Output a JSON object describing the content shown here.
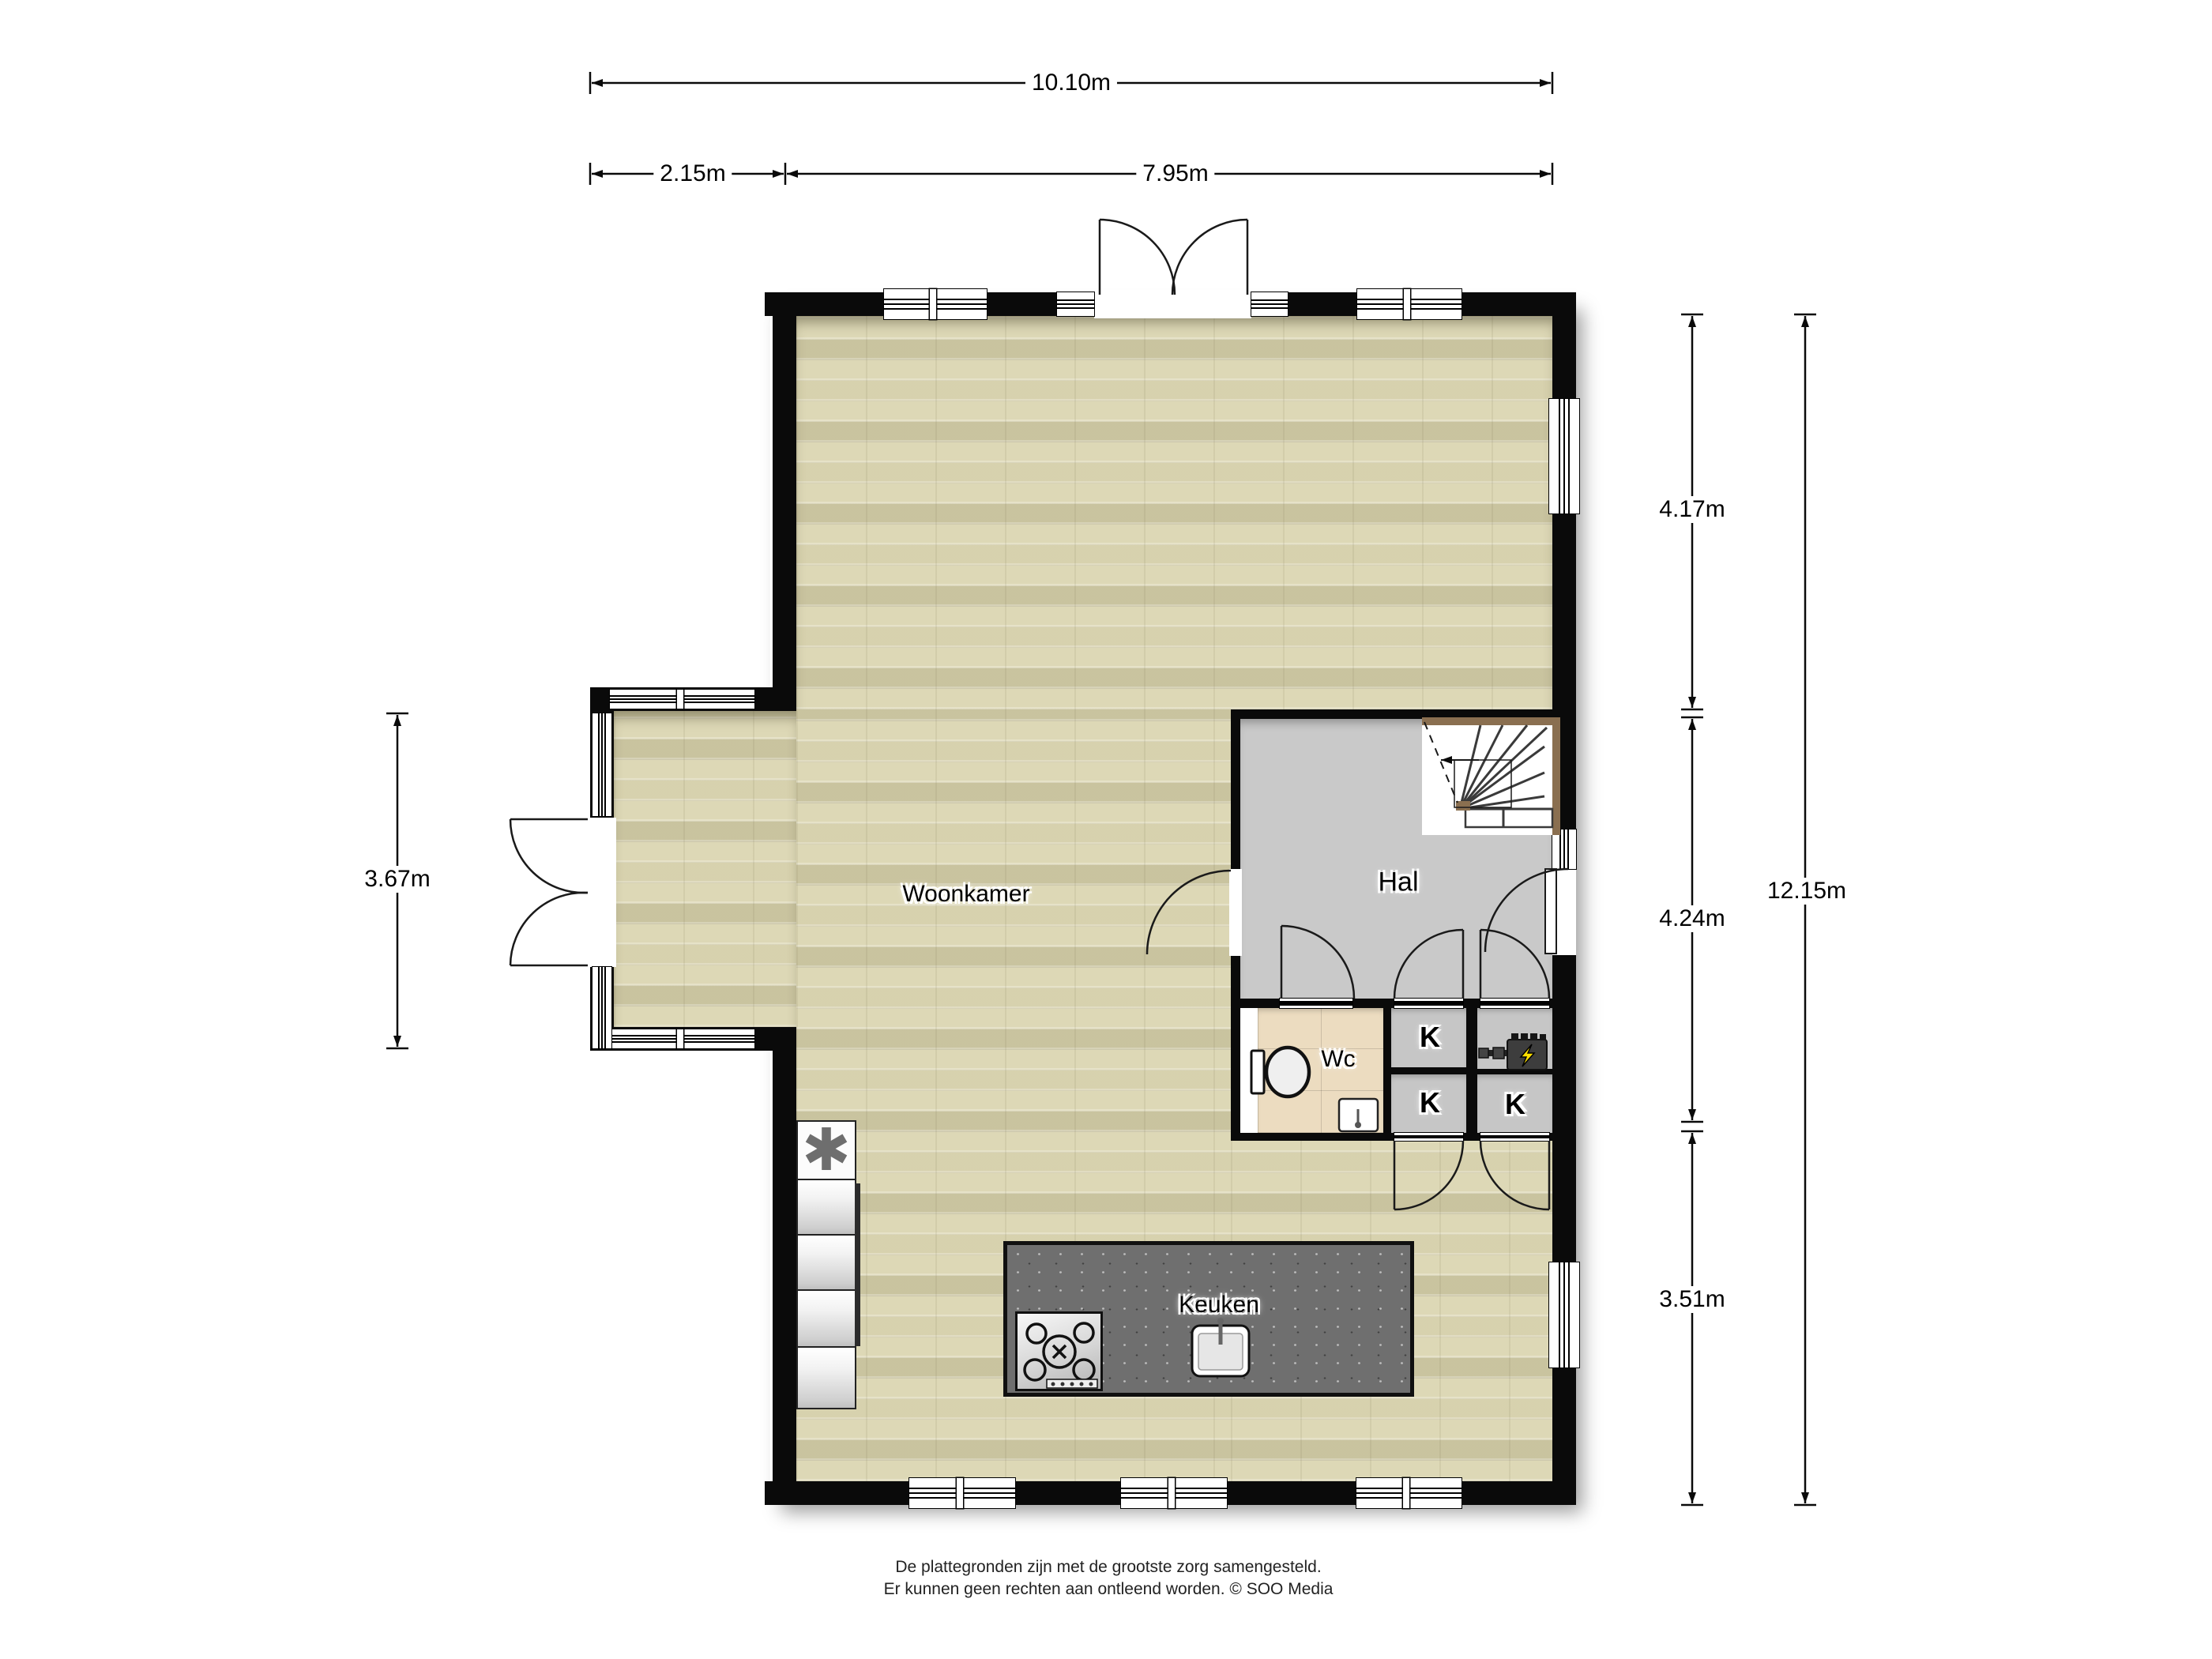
{
  "title": "Floor plan ground floor",
  "dimensions": {
    "top_total": "10.10m",
    "top_left_segment": "2.15m",
    "top_right_segment": "7.95m",
    "left_side": "3.67m",
    "right_upper": "4.17m",
    "right_middle": "4.24m",
    "right_lower": "3.51m",
    "right_total": "12.15m"
  },
  "rooms": {
    "living": "Woonkamer",
    "hall": "Hal",
    "toilet": "Wc",
    "kitchen": "Keuken",
    "closet": "K"
  },
  "icons": {
    "freezer_glyph": "✱",
    "freezer_meaning": "freezer-appliance",
    "boiler_meaning": "boiler-with-lightning-bolt",
    "stair_arrow_meaning": "stair-direction-arrow"
  },
  "footer": {
    "line1": "De plattegronden zijn met de grootste zorg samengesteld.",
    "line2": "Er kunnen geen rechten aan ontleend worden. © SOO Media"
  },
  "colors": {
    "wall": "#0a0a0a",
    "wood_floor": "#ddd8b6",
    "hall_floor": "#c9c9c9",
    "wc_tile": "#ecdcc0",
    "closet_floor": "#c6c6c6",
    "island_counter": "#6f6f6f",
    "stair_wood": "#8a6f50",
    "boiler_bolt": "#ffe000"
  }
}
